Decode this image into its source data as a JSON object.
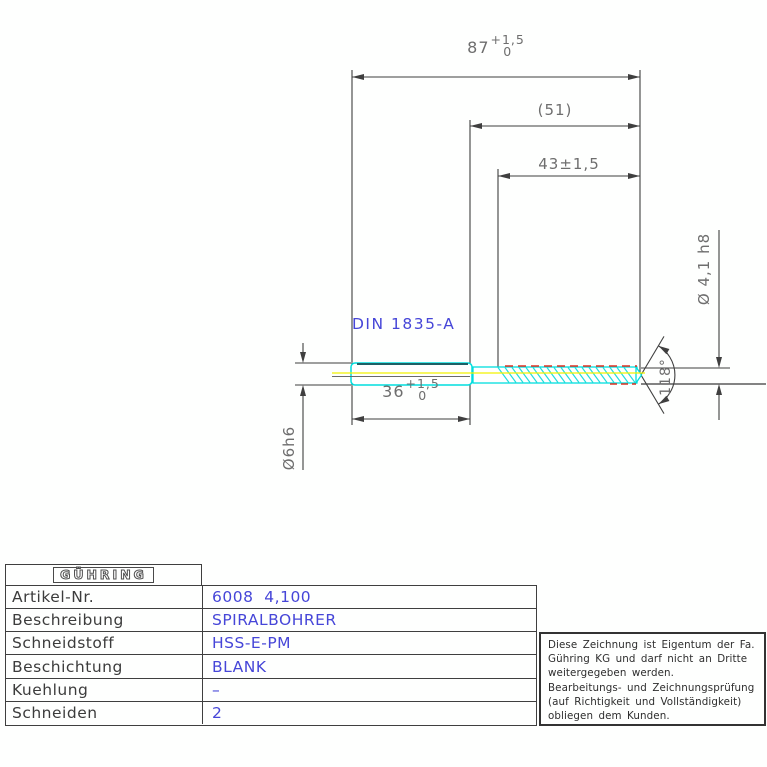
{
  "drawing": {
    "standard_label": "DIN 1835-A",
    "dims": {
      "overall_length": {
        "value": "87",
        "tol_up": "+1,5",
        "tol_dn": "0"
      },
      "ref_length": "(51)",
      "flute_length": "43±1,5",
      "shank_length": {
        "value": "36",
        "tol_up": "+1,5",
        "tol_dn": "0"
      },
      "shank_diameter": "Ø6h6",
      "drill_diameter": "Ø 4,1 h8",
      "point_angle": "118°"
    },
    "colors": {
      "outline_cyan": "#00dede",
      "shank_top_teal": "#1e6066",
      "centerline_yellow": "#f2f200",
      "margin_red": "#e03020",
      "line_gray": "#3f3f3f",
      "dim_text_gray": "#6e6e6e",
      "value_blue": "#4646d8"
    }
  },
  "titleblock": {
    "logo": "GÜHRING",
    "rows": [
      {
        "label": "Artikel-Nr.",
        "value": "6008  4,100"
      },
      {
        "label": "Beschreibung",
        "value": "SPIRALBOHRER"
      },
      {
        "label": "Schneidstoff",
        "value": "HSS-E-PM"
      },
      {
        "label": "Beschichtung",
        "value": "BLANK"
      },
      {
        "label": "Kuehlung",
        "value": "–"
      },
      {
        "label": "Schneiden",
        "value": "2"
      }
    ]
  },
  "notice": {
    "lines": [
      "Diese Zeichnung ist Eigentum der Fa.",
      "Gühring KG und darf nicht an Dritte",
      "weitergegeben werden.",
      "Bearbeitungs- und Zeichnungsprüfung",
      "(auf Richtigkeit und Vollständigkeit)",
      "obliegen dem Kunden."
    ]
  }
}
